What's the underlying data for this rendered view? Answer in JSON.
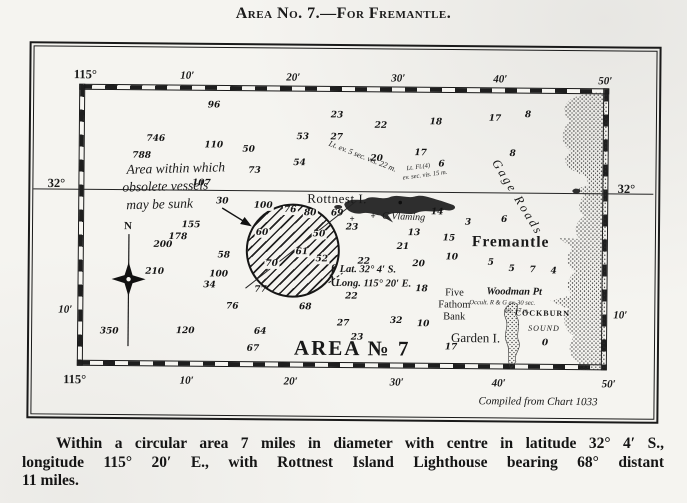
{
  "title": "Area No. 7.—For Fremantle.",
  "caption": {
    "line1": "Within a circular area 7 miles in diameter with centre in latitude 32° 4′ S.,",
    "line2": "longitude 115° 20′ E., with Rottnest Island Lighthouse bearing 68° distant",
    "line3": "11 miles."
  },
  "map": {
    "credit": "Compiled from Chart 1033",
    "area_label": "AREA № 7",
    "compass": {
      "north": "N"
    },
    "grid": {
      "top": [
        "115°",
        "10′",
        "20′",
        "30′",
        "40′",
        "50′"
      ],
      "bottom": [
        "115°",
        "10′",
        "20′",
        "30′",
        "40′",
        "50′"
      ],
      "left": [
        "32°",
        "10′"
      ],
      "right": [
        "32°",
        "10′"
      ]
    },
    "note": {
      "line1": "Area within which",
      "line2": "obsolete vessels",
      "line3": "may be sunk"
    },
    "position": {
      "brace": "{",
      "lat": "Lat. 32° 4′ S.",
      "long": "Long. 115° 20′ E."
    },
    "places": {
      "rottnest": "Rottnest I.",
      "c_vlaming": "C Vlaming",
      "gage_roads": "Gage Roads",
      "fremantle": "Fremantle",
      "five_fathom": [
        "Five",
        "Fathom",
        "Bank"
      ],
      "woodman": "Woodman Pt",
      "cockburn": "COCKBURN",
      "sound": "SOUND",
      "garden": "Garden I."
    },
    "lights": {
      "rottnest_main": "Lt. ev. 5 sec. vis. 22 m.",
      "rottnest_group_1": "Lt. Fl.(4)",
      "rottnest_group_2": "ev. sec. vis. 15 m.",
      "woodman_1": "Occult. R & G ev. 30 sec.",
      "woodman_2": "vis. 17 m."
    },
    "soundings": [
      {
        "x": 213,
        "y": 107,
        "v": "96"
      },
      {
        "x": 155,
        "y": 141,
        "v": "746"
      },
      {
        "x": 213,
        "y": 147,
        "v": "110"
      },
      {
        "x": 248,
        "y": 151,
        "v": "50"
      },
      {
        "x": 141,
        "y": 158,
        "v": "788"
      },
      {
        "x": 254,
        "y": 172,
        "v": "73"
      },
      {
        "x": 201,
        "y": 185,
        "v": "107"
      },
      {
        "x": 222,
        "y": 203,
        "v": "30"
      },
      {
        "x": 191,
        "y": 227,
        "v": "155"
      },
      {
        "x": 178,
        "y": 239,
        "v": "178"
      },
      {
        "x": 163,
        "y": 247,
        "v": "200"
      },
      {
        "x": 155,
        "y": 274,
        "v": "210"
      },
      {
        "x": 224,
        "y": 257,
        "v": "58"
      },
      {
        "x": 219,
        "y": 276,
        "v": "100"
      },
      {
        "x": 210,
        "y": 287,
        "v": "34"
      },
      {
        "x": 233,
        "y": 308,
        "v": "76"
      },
      {
        "x": 186,
        "y": 333,
        "v": "120"
      },
      {
        "x": 110,
        "y": 334,
        "v": "350"
      },
      {
        "x": 261,
        "y": 291,
        "v": "77"
      },
      {
        "x": 261,
        "y": 333,
        "v": "64"
      },
      {
        "x": 254,
        "y": 350,
        "v": "67"
      },
      {
        "x": 306,
        "y": 308,
        "v": "68"
      },
      {
        "x": 344,
        "y": 324,
        "v": "27"
      },
      {
        "x": 358,
        "y": 338,
        "v": "23"
      },
      {
        "x": 336,
        "y": 116,
        "v": "23"
      },
      {
        "x": 380,
        "y": 126,
        "v": "22"
      },
      {
        "x": 302,
        "y": 138,
        "v": "53"
      },
      {
        "x": 336,
        "y": 138,
        "v": "27"
      },
      {
        "x": 299,
        "y": 164,
        "v": "54"
      },
      {
        "x": 376,
        "y": 159,
        "v": "20"
      },
      {
        "x": 435,
        "y": 122,
        "v": "18"
      },
      {
        "x": 494,
        "y": 118,
        "v": "17"
      },
      {
        "x": 527,
        "y": 114,
        "v": "8"
      },
      {
        "x": 420,
        "y": 153,
        "v": "17"
      },
      {
        "x": 441,
        "y": 164,
        "v": "6"
      },
      {
        "x": 512,
        "y": 153,
        "v": "8"
      },
      {
        "x": 263,
        "y": 207,
        "v": "100",
        "c": 1
      },
      {
        "x": 290,
        "y": 211,
        "v": "76",
        "c": 1
      },
      {
        "x": 310,
        "y": 214,
        "v": "80",
        "c": 1
      },
      {
        "x": 262,
        "y": 234,
        "v": "60",
        "c": 1
      },
      {
        "x": 319,
        "y": 235,
        "v": "50",
        "c": 1
      },
      {
        "x": 302,
        "y": 253,
        "v": "61",
        "c": 1
      },
      {
        "x": 322,
        "y": 260,
        "v": "52",
        "c": 1
      },
      {
        "x": 272,
        "y": 265,
        "v": "70",
        "c": 1
      },
      {
        "x": 337,
        "y": 214,
        "v": "69"
      },
      {
        "x": 352,
        "y": 228,
        "v": "23"
      },
      {
        "x": 437,
        "y": 212,
        "v": "14"
      },
      {
        "x": 468,
        "y": 222,
        "v": "3"
      },
      {
        "x": 504,
        "y": 219,
        "v": "6"
      },
      {
        "x": 414,
        "y": 233,
        "v": "13"
      },
      {
        "x": 449,
        "y": 238,
        "v": "15"
      },
      {
        "x": 403,
        "y": 247,
        "v": "21"
      },
      {
        "x": 452,
        "y": 257,
        "v": "10"
      },
      {
        "x": 364,
        "y": 262,
        "v": "22"
      },
      {
        "x": 419,
        "y": 264,
        "v": "20"
      },
      {
        "x": 491,
        "y": 262,
        "v": "5"
      },
      {
        "x": 512,
        "y": 268,
        "v": "5"
      },
      {
        "x": 533,
        "y": 269,
        "v": "7"
      },
      {
        "x": 554,
        "y": 270,
        "v": "4"
      },
      {
        "x": 422,
        "y": 289,
        "v": "18"
      },
      {
        "x": 352,
        "y": 297,
        "v": "22"
      },
      {
        "x": 397,
        "y": 321,
        "v": "32"
      },
      {
        "x": 424,
        "y": 324,
        "v": "10"
      },
      {
        "x": 452,
        "y": 347,
        "v": "17"
      },
      {
        "x": 546,
        "y": 342,
        "v": "0"
      }
    ],
    "symbols": [
      {
        "x": 373,
        "y": 216,
        "glyph": "+"
      },
      {
        "x": 352,
        "y": 219,
        "glyph": "+"
      }
    ]
  }
}
